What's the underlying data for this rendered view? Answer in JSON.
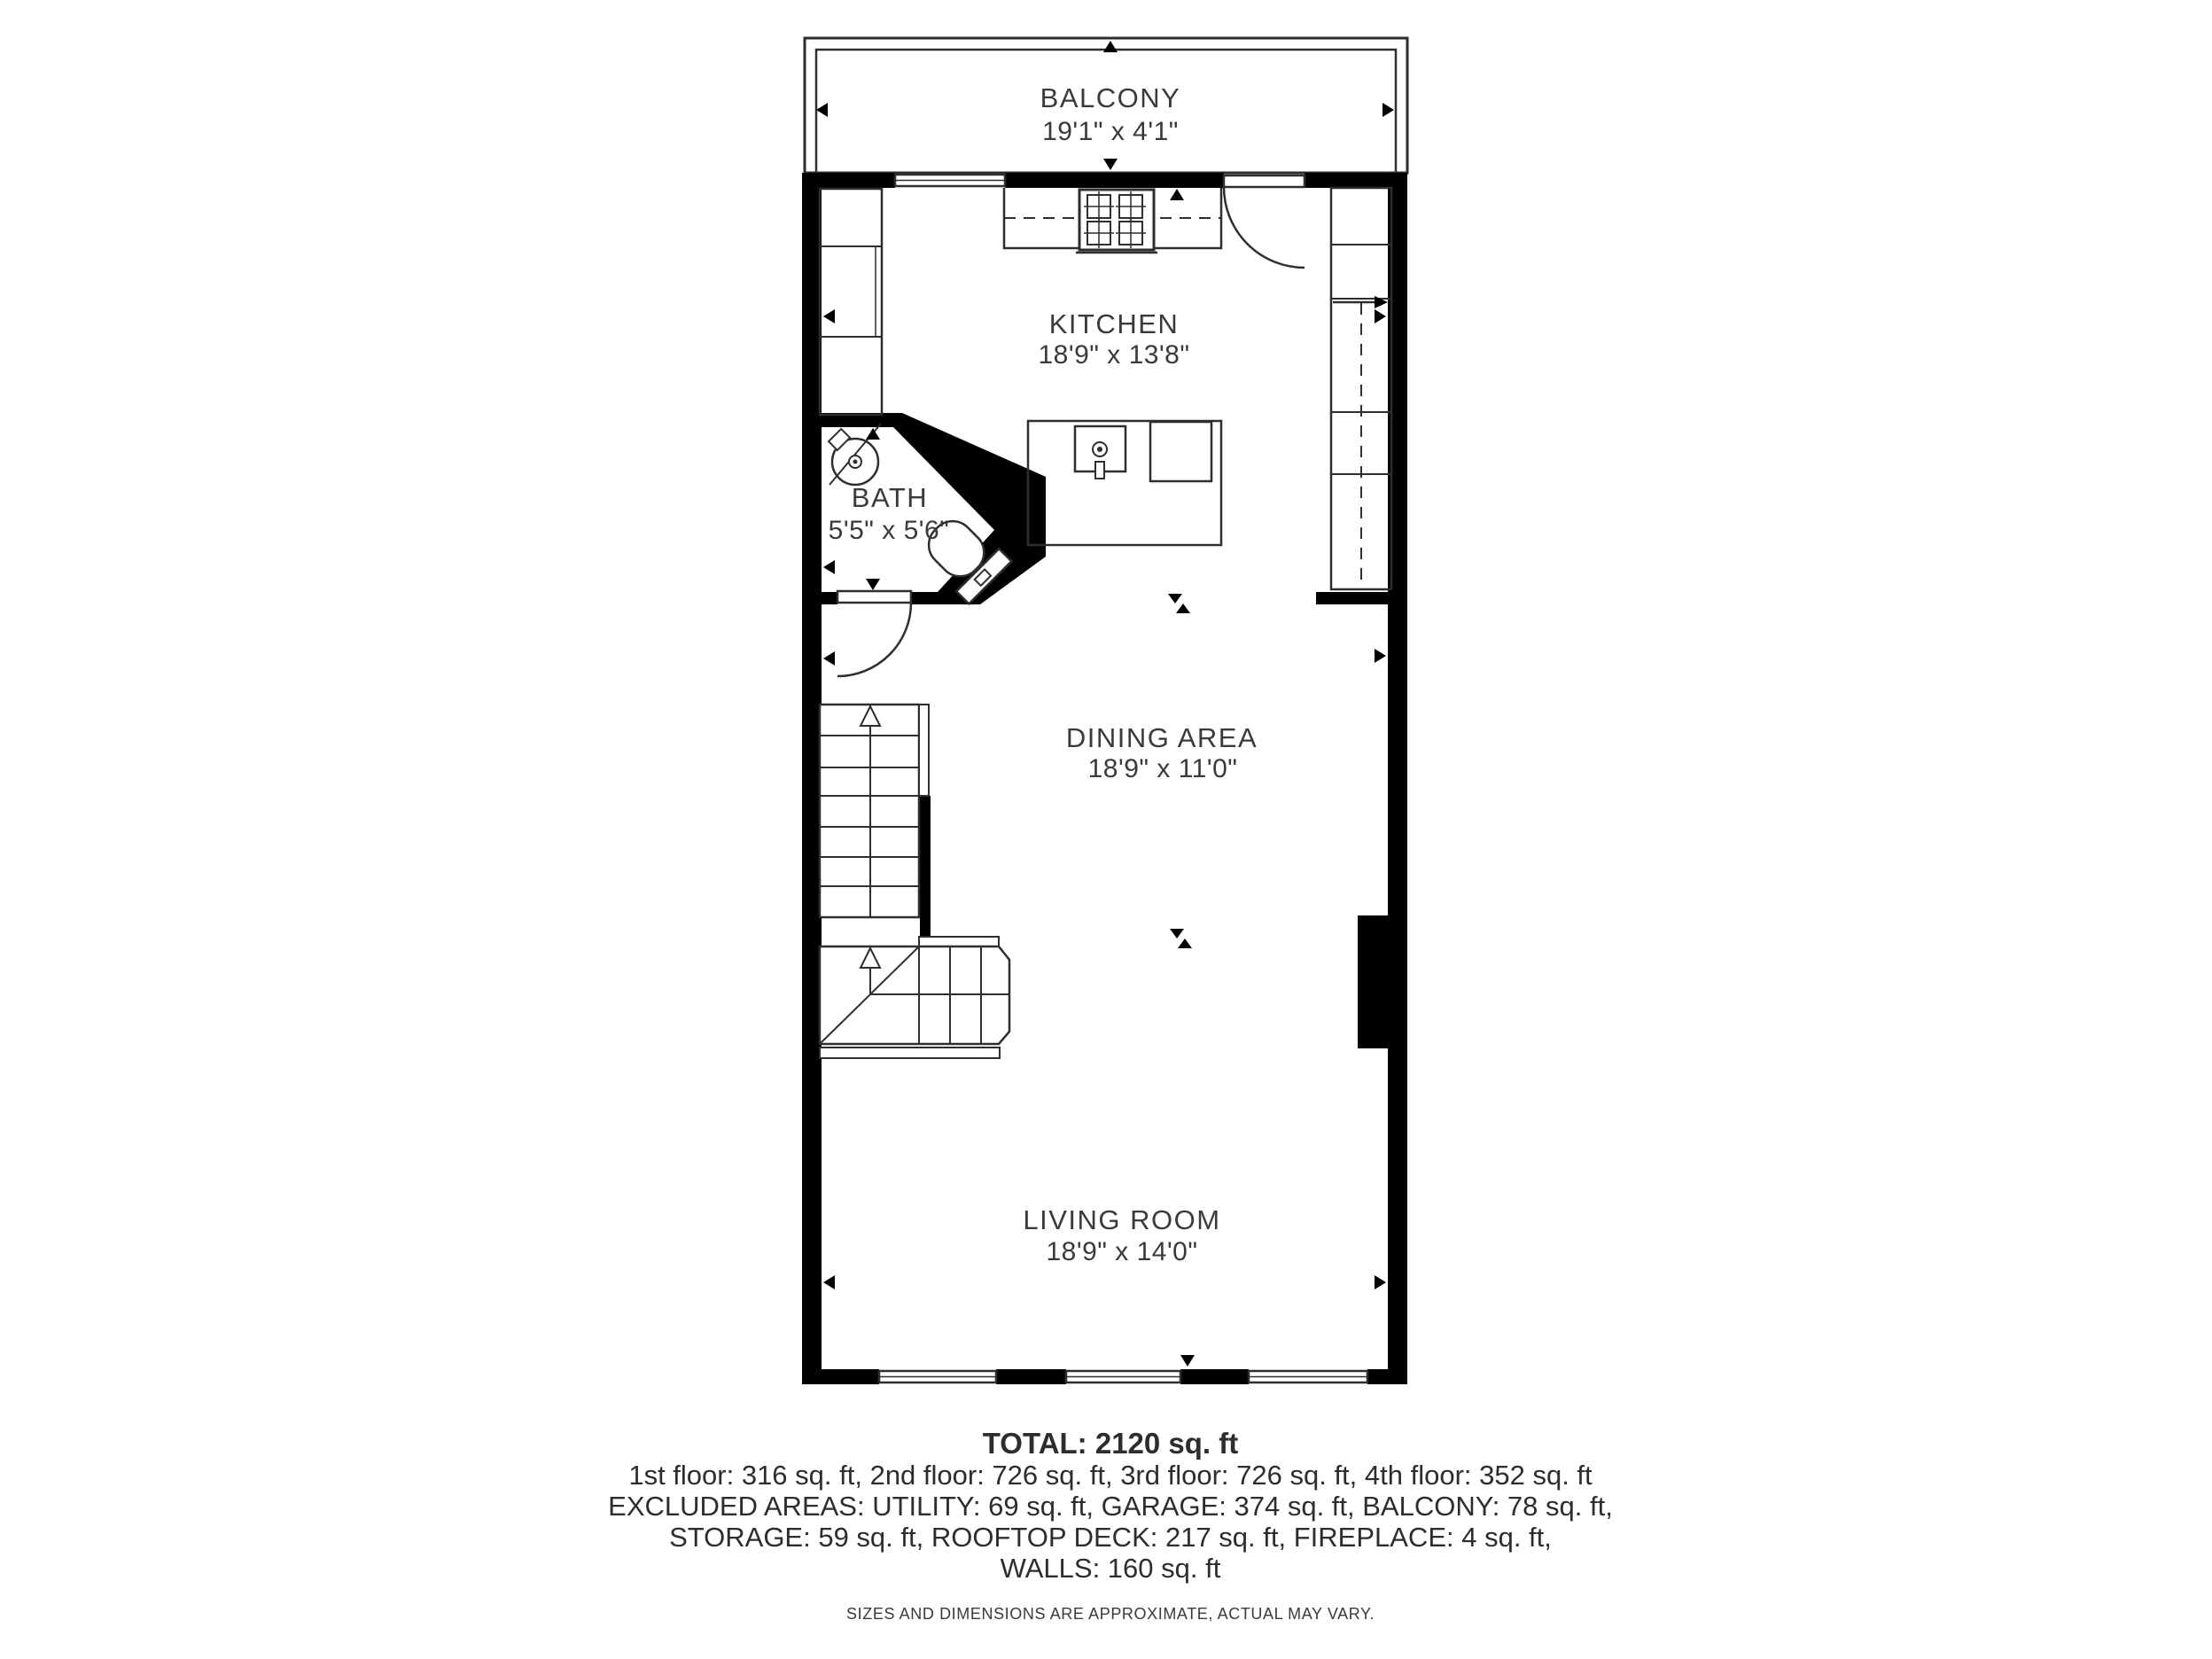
{
  "floorplan": {
    "rooms": [
      {
        "id": "balcony",
        "name": "BALCONY",
        "dims": "19'1\" x 4'1\""
      },
      {
        "id": "kitchen",
        "name": "KITCHEN",
        "dims": "18'9\" x 13'8\""
      },
      {
        "id": "bath",
        "name": "BATH",
        "dims": "5'5\" x 5'6\""
      },
      {
        "id": "dining",
        "name": "DINING AREA",
        "dims": "18'9\" x 11'0\""
      },
      {
        "id": "living",
        "name": "LIVING ROOM",
        "dims": "18'9\" x 14'0\""
      }
    ],
    "fixtures": [
      "stove",
      "kitchen-sink",
      "island",
      "dishwasher",
      "bath-sink",
      "toilet",
      "fireplace",
      "stairs-up",
      "stairs-down",
      "cabinets"
    ],
    "markers": [
      "dimension-triangle",
      "opening-bowtie",
      "stair-direction-arrow"
    ]
  },
  "summary": {
    "total": "TOTAL: 2120 sq. ft",
    "floors": "1st floor: 316 sq. ft, 2nd floor: 726 sq. ft, 3rd floor: 726 sq. ft, 4th floor: 352 sq. ft",
    "excluded1": "EXCLUDED AREAS: UTILITY: 69 sq. ft, GARAGE: 374 sq. ft, BALCONY: 78 sq. ft,",
    "excluded2": "STORAGE: 59 sq. ft, ROOFTOP DECK: 217 sq. ft, FIREPLACE: 4 sq. ft,",
    "excluded3": "WALLS: 160 sq. ft",
    "disclaimer": "SIZES AND DIMENSIONS ARE APPROXIMATE, ACTUAL MAY VARY."
  },
  "colors": {
    "walls": "#000000",
    "lines": "#2e2e2e",
    "text": "#3a3a3a",
    "background": "#ffffff"
  }
}
